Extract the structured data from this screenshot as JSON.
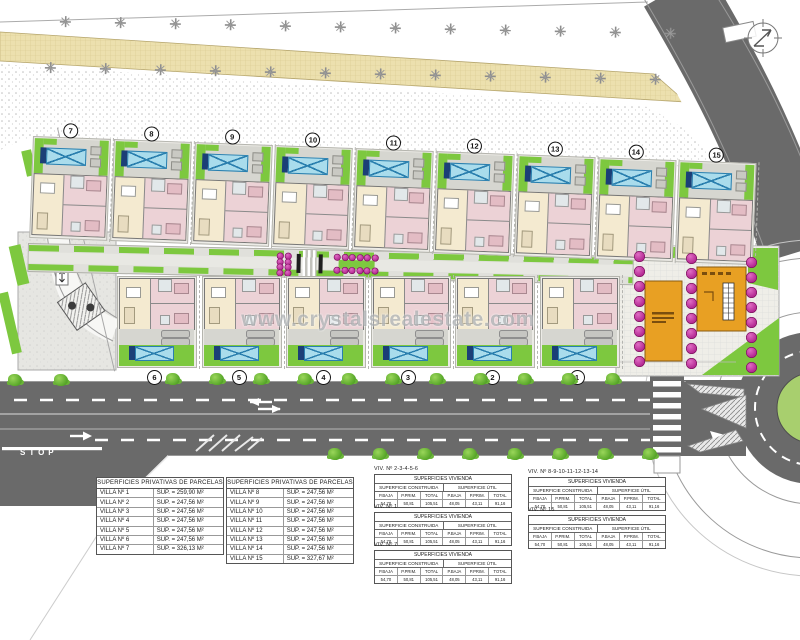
{
  "watermark": "www.crystalsrealestate.com",
  "road": {
    "stop_label": "STOP"
  },
  "icons": {
    "compass": "north-arrow-icon",
    "pool": "pool-icon",
    "tree": "tree-icon",
    "bush": "bush-icon",
    "flower": "flowering-tree-icon"
  },
  "colors": {
    "lawn": "#7dc83f",
    "pool": "#a9dcec",
    "asphalt": "#6a6a6a",
    "path_band": "#ece0ae",
    "building": "#e8a023",
    "magenta": "#b0208d",
    "roundabout_green": "#a8cf6e"
  },
  "top_villas": [
    {
      "num": "7"
    },
    {
      "num": "8"
    },
    {
      "num": "9"
    },
    {
      "num": "10"
    },
    {
      "num": "11"
    },
    {
      "num": "12"
    },
    {
      "num": "13"
    },
    {
      "num": "14"
    },
    {
      "num": "15"
    }
  ],
  "bottom_villas": [
    {
      "num": "6"
    },
    {
      "num": "5"
    },
    {
      "num": "4"
    },
    {
      "num": "3"
    },
    {
      "num": "2"
    },
    {
      "num": "1"
    }
  ],
  "decor": {
    "top_trees": 12,
    "road_bushes_left": 2,
    "road_bushes_top": 11,
    "road_bushes_bottom": 8,
    "flowers_per_column": 8,
    "walkway_cluster_a": 8,
    "walkway_cluster_b": 12
  },
  "parcel_tables": [
    {
      "title": "SUPERFICIES PRIVATIVAS DE PARCELAS",
      "rows": [
        {
          "villa": "VILLA Nº 1",
          "sup": "SUP. = 259,90 M²"
        },
        {
          "villa": "VILLA Nº 2",
          "sup": "SUP. = 247,56 M²"
        },
        {
          "villa": "VILLA Nº 3",
          "sup": "SUP. = 247,56 M²"
        },
        {
          "villa": "VILLA Nº 4",
          "sup": "SUP. = 247,56 M²"
        },
        {
          "villa": "VILLA Nº 5",
          "sup": "SUP. = 247,56 M²"
        },
        {
          "villa": "VILLA Nº 6",
          "sup": "SUP. = 247,56 M²"
        },
        {
          "villa": "VILLA Nº 7",
          "sup": "SUP. = 326,13 M²"
        }
      ]
    },
    {
      "title": "SUPERFICIES PRIVATIVAS DE PARCELAS",
      "rows": [
        {
          "villa": "VILLA Nº 8",
          "sup": "SUP. = 247,56 M²"
        },
        {
          "villa": "VILLA Nº 9",
          "sup": "SUP. = 247,56 M²"
        },
        {
          "villa": "VILLA Nº 10",
          "sup": "SUP. = 247,56 M²"
        },
        {
          "villa": "VILLA Nº 11",
          "sup": "SUP. = 247,56 M²"
        },
        {
          "villa": "VILLA Nº 12",
          "sup": "SUP. = 247,56 M²"
        },
        {
          "villa": "VILLA Nº 13",
          "sup": "SUP. = 247,56 M²"
        },
        {
          "villa": "VILLA Nº 14",
          "sup": "SUP. = 247,56 M²"
        },
        {
          "villa": "VILLA Nº 15",
          "sup": "SUP. = 327,67 M²"
        }
      ]
    }
  ],
  "vivienda_header": {
    "title": "SUPERFICIES VIVIENDA",
    "groups": [
      "SUPERFICIE CONSTRUIDA",
      "SUPERFICIE ÚTIL"
    ],
    "cols": [
      "P.BAJA",
      "P.PRIM.",
      "TOTAL"
    ]
  },
  "vivienda_tables": [
    {
      "label": "VIV. Nº 2-3-4-5-6",
      "cb": "54,70",
      "cp": "50,81",
      "ct": "105,51",
      "ub": "48,05",
      "up": "43,11",
      "ut": "91,16"
    },
    {
      "label": "VIV. Nº 1",
      "cb": "54,70",
      "cp": "50,81",
      "ct": "105,51",
      "ub": "48,05",
      "up": "43,11",
      "ut": "91,16"
    },
    {
      "label": "VIV. Nº 7",
      "cb": "54,70",
      "cp": "50,81",
      "ct": "105,51",
      "ub": "48,05",
      "up": "43,11",
      "ut": "91,16"
    },
    {
      "label": "VIV. Nº 8-9-10-11-12-13-14",
      "cb": "54,70",
      "cp": "50,81",
      "ct": "105,51",
      "ub": "48,05",
      "up": "43,11",
      "ut": "91,16"
    },
    {
      "label": "VIV. Nº 15",
      "cb": "54,70",
      "cp": "50,81",
      "ct": "105,51",
      "ub": "48,05",
      "up": "43,11",
      "ut": "91,16"
    }
  ]
}
